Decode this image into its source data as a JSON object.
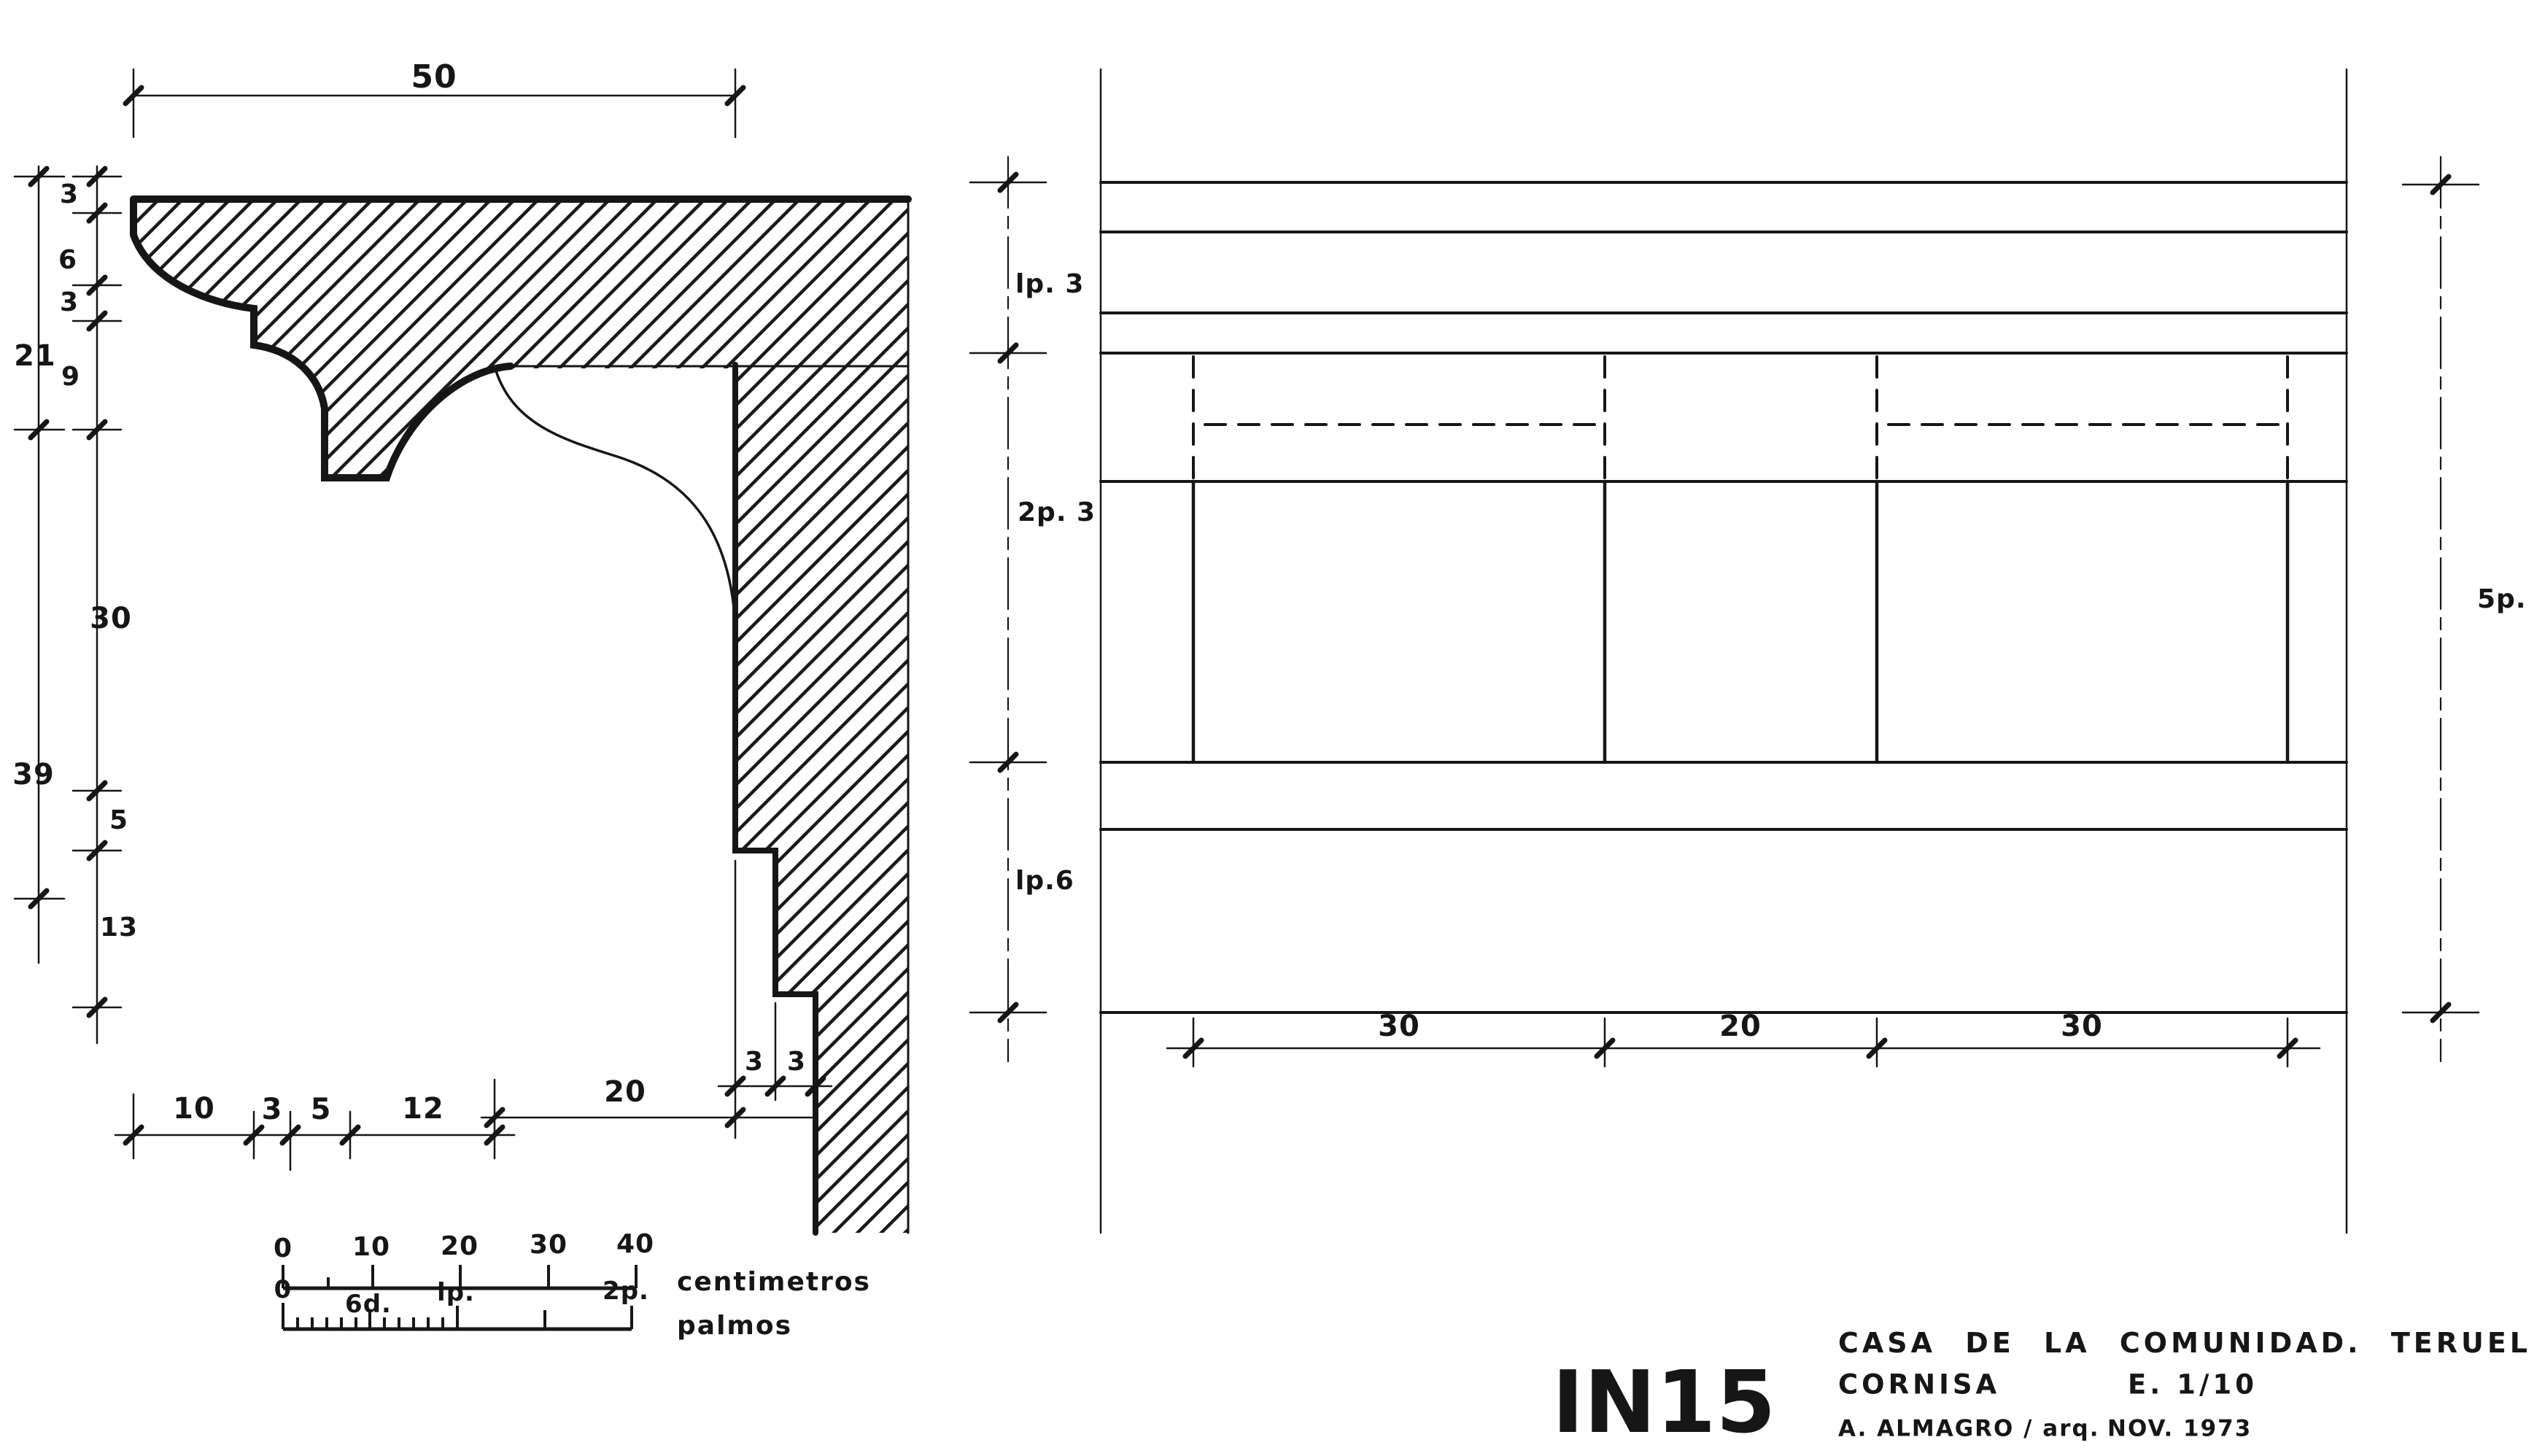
{
  "sheet": {
    "ink_color": "#161616",
    "paper_color": "#ffffff"
  },
  "section_view": {
    "top_dim": "50",
    "outer_dims": [
      "21",
      "39"
    ],
    "inner_dims": [
      "3",
      "6",
      "3",
      "9",
      "30",
      "5",
      "13"
    ],
    "bottom_dims": [
      "10",
      "3",
      "5",
      "12",
      "20"
    ],
    "wall_step_dims": [
      "3",
      "3"
    ]
  },
  "scale_bars": {
    "centimeters": {
      "ticks": [
        "0",
        "10",
        "20",
        "30",
        "40"
      ],
      "label": "centimetros"
    },
    "palmos": {
      "ticks": [
        "0",
        "6d.",
        "lp.",
        "2p."
      ],
      "label": "palmos"
    }
  },
  "elevation_view": {
    "left_dims": [
      "lp. 3",
      "2p. 3",
      "lp.6"
    ],
    "right_dim": "5p.",
    "bottom_dims": [
      "30",
      "20",
      "30"
    ]
  },
  "title_block": {
    "drawing_code": "IN15",
    "project": "CASA DE LA COMUNIDAD. TERUEL",
    "subject": "CORNISA",
    "scale": "E. 1/10",
    "author": "A. ALMAGRO / arq.",
    "date": "NOV. 1973"
  }
}
